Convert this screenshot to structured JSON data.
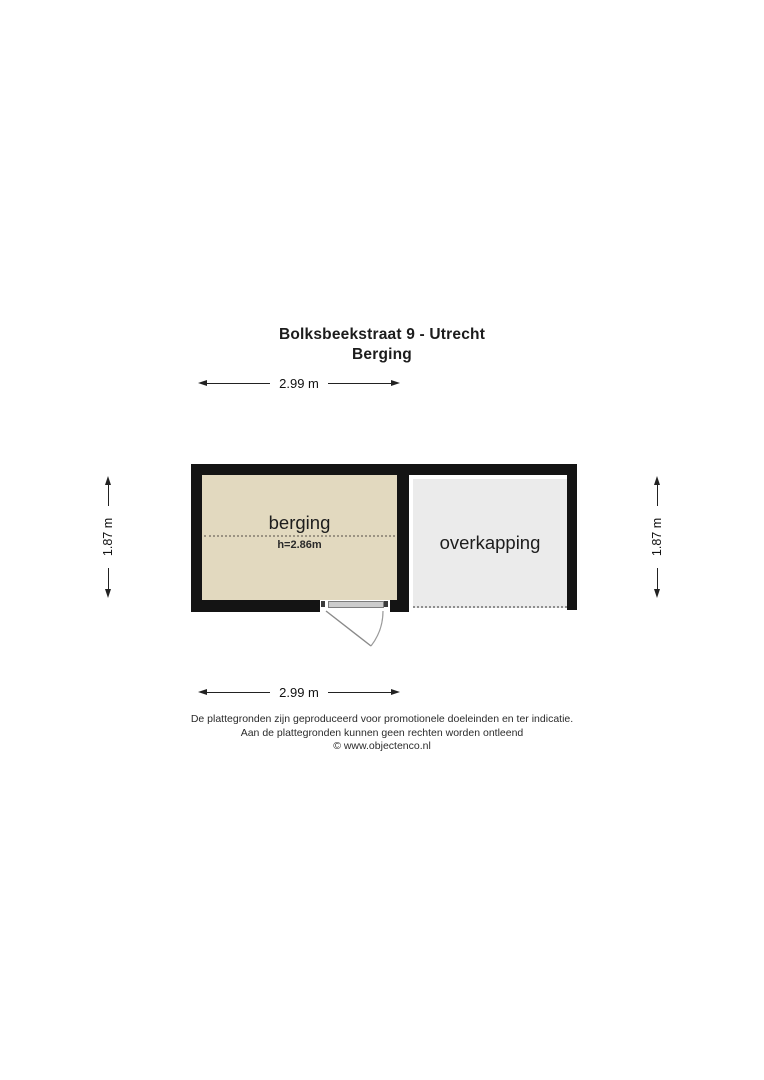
{
  "title": "Bolksbeekstraat 9 - Utrecht",
  "subtitle": "Berging",
  "dimensions": {
    "top": "2.99 m",
    "bottom": "2.99 m",
    "left": "1.87 m",
    "right": "1.87 m"
  },
  "rooms": {
    "berging": {
      "label": "berging",
      "height_note": "h=2.86m",
      "fill": "#e2d9bf"
    },
    "overkapping": {
      "label": "overkapping",
      "fill": "#ebebeb"
    }
  },
  "footer": {
    "line1": "De plattegronden zijn geproduceerd voor promotionele doeleinden en ter indicatie.",
    "line2": "Aan de plattegronden kunnen geen rechten worden ontleend",
    "line3": "© www.objectenco.nl"
  },
  "colors": {
    "wall": "#141414",
    "dimension_line": "#222222",
    "door_line": "#8a8a8a",
    "overkapping_dotted_edge": "#8f8f8f",
    "berging_midline": "#9b9383"
  }
}
